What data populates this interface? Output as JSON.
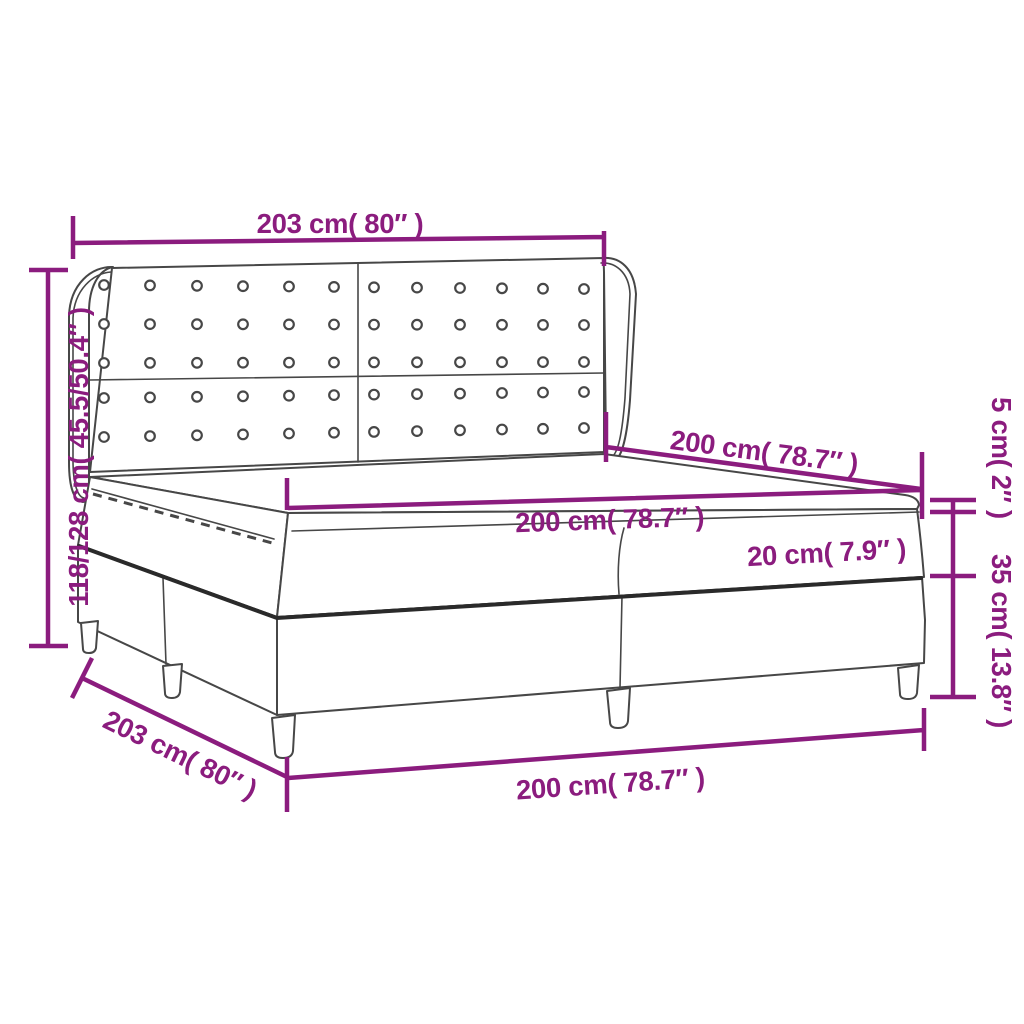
{
  "colors": {
    "dimension": "#8B1C7E",
    "line_art": "#474747",
    "line_heavy": "#2a2a2a",
    "background": "#ffffff"
  },
  "labels": {
    "headboard_width": "203 cm( 80″ )",
    "headboard_height": "118/128 cm( 45.5/50.4″ )",
    "bed_length": "200 cm( 78.7″ )",
    "mattress_width": "200 cm( 78.7″ )",
    "mattress_thickness": "20 cm( 7.9″ )",
    "topper_thickness": "5 cm( 2″ )",
    "base_height": "35 cm( 13.8″ )",
    "frame_depth": "203 cm( 80″ )",
    "frame_width_bottom": "200 cm( 78.7″ )"
  }
}
